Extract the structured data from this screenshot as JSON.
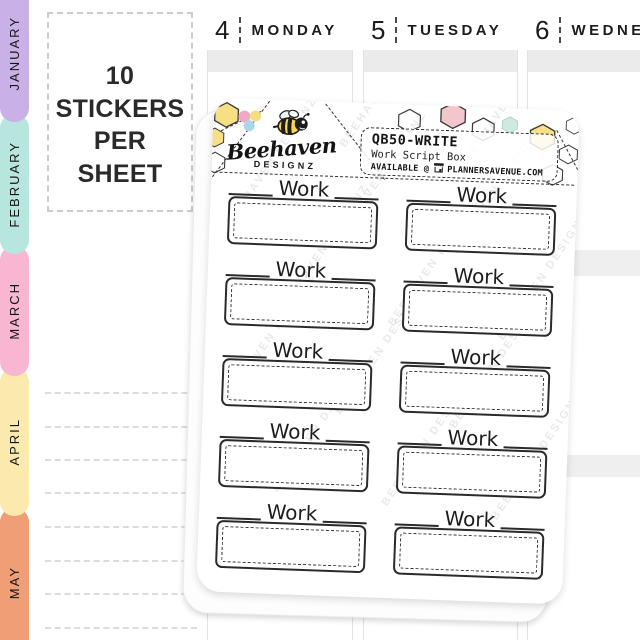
{
  "planner": {
    "info_box": {
      "line1": "10 STICKERS",
      "line2": "PER SHEET"
    },
    "tabs": [
      {
        "label": "JANUARY",
        "color": "#c9b1e8"
      },
      {
        "label": "FEBRUARY",
        "color": "#b6e6de"
      },
      {
        "label": "MARCH",
        "color": "#f8b6d2"
      },
      {
        "label": "APRIL",
        "color": "#fbe9ae"
      },
      {
        "label": "MAY",
        "color": "#ef9e75"
      }
    ],
    "days": [
      {
        "num": "4",
        "name": "MONDAY"
      },
      {
        "num": "5",
        "name": "TUESDAY"
      },
      {
        "num": "6",
        "name": "WEDNESDAY"
      }
    ]
  },
  "sheet": {
    "brand": {
      "script": "Beehaven",
      "sub": "DESIGNZ"
    },
    "label": {
      "sku": "QB50-WRITE",
      "product": "Work Script Box",
      "availability": "AVAILABLE @",
      "site": "PLANNERSAVENUE.COM"
    },
    "watermark": "BEEHAVEN DESIGNZ",
    "stickers": [
      {
        "label": "Work"
      },
      {
        "label": "Work"
      },
      {
        "label": "Work"
      },
      {
        "label": "Work"
      },
      {
        "label": "Work"
      },
      {
        "label": "Work"
      },
      {
        "label": "Work"
      },
      {
        "label": "Work"
      },
      {
        "label": "Work"
      },
      {
        "label": "Work"
      }
    ],
    "decor_colors": {
      "yellow": "#f6df85",
      "pink": "#f2c6ca",
      "mint": "#cfe9df",
      "dot_pink": "#f2a9c5",
      "dot_yellow": "#f3df7e",
      "dot_blue": "#a9d6e8"
    }
  }
}
